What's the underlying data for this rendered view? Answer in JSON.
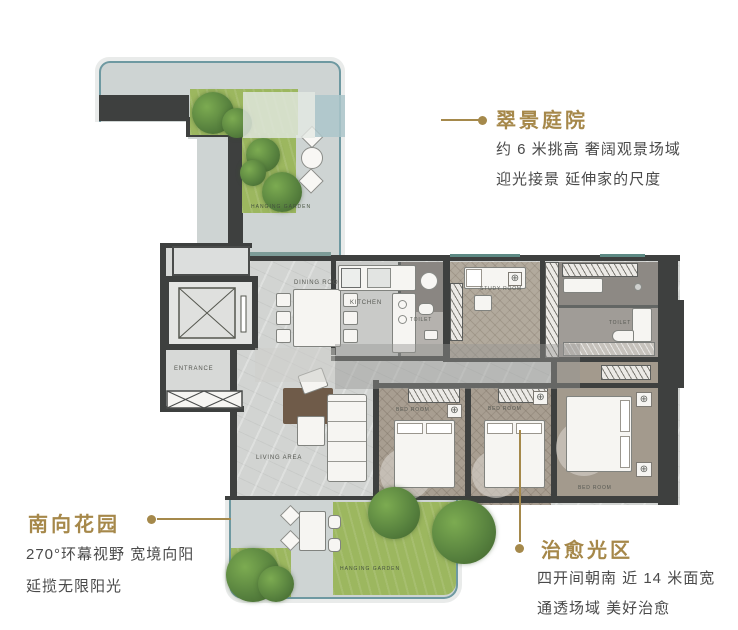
{
  "callouts": {
    "courtyard": {
      "title": "翠景庭院",
      "line1": "约 6 米挑高 奢阔观景场域",
      "line2": "迎光接景 延伸家的尺度"
    },
    "south_garden": {
      "title": "南向花园",
      "line1": "270°环幕视野 宽境向阳",
      "line2": "延揽无限阳光"
    },
    "healing_light": {
      "title": "治愈光区",
      "line1": "四开间朝南 近 14 米面宽",
      "line2": "通透场域 美好治愈"
    }
  },
  "floorplan": {
    "labels": {
      "hanging_garden_top": "HANGING GARDEN",
      "hanging_garden_bottom": "HANGING GARDEN",
      "entrance": "ENTRANCE",
      "dining_room": "DINING ROOM",
      "kitchen": "KITCHEN",
      "toilet_1": "TOILET",
      "toilet_2": "TOILET",
      "study_room": "STUDY ROOM",
      "living_area": "LIVING AREA",
      "bedroom_1": "BED ROOM",
      "bedroom_2": "BED ROOM",
      "master_bedroom": "BED ROOM"
    }
  },
  "icons": {
    "ceiling_light": "⊕",
    "downlight": "◎"
  },
  "colors": {
    "accent_gold": "#a6884a",
    "body_text": "#4a4a4a",
    "teal_border": "#6e99a1",
    "grass_green": "#9cb75f",
    "wall_dark": "#3e403f"
  }
}
